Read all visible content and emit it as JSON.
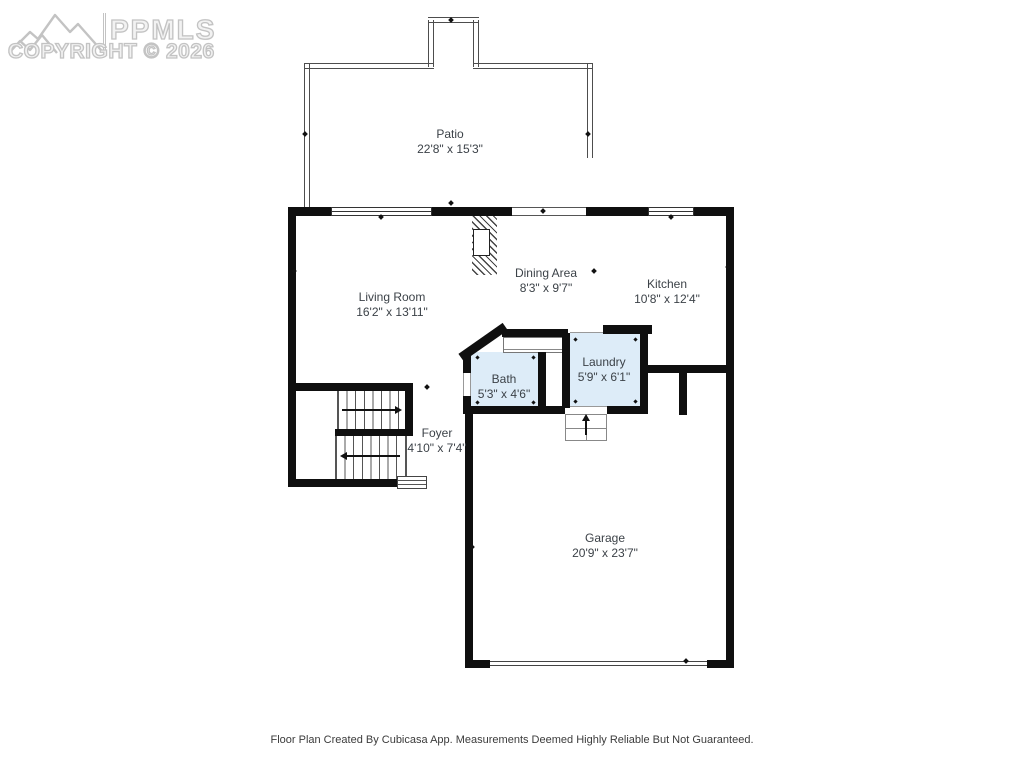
{
  "watermark": {
    "brand": "PPMLS",
    "copyright": "COPYRIGHT © 2026",
    "logo": "mountain-range-icon",
    "color": "#c3c3c3"
  },
  "rooms": {
    "patio": {
      "name": "Patio",
      "dims": "22'8\" x 15'3\""
    },
    "living_room": {
      "name": "Living Room",
      "dims": "16'2\" x 13'11\""
    },
    "dining_area": {
      "name": "Dining Area",
      "dims": "8'3\" x 9'7\""
    },
    "kitchen": {
      "name": "Kitchen",
      "dims": "10'8\" x 12'4\""
    },
    "bath": {
      "name": "Bath",
      "dims": "5'3\" x 4'6\""
    },
    "laundry": {
      "name": "Laundry",
      "dims": "5'9\" x 6'1\""
    },
    "foyer": {
      "name": "Foyer",
      "dims": "4'10\" x 7'4\""
    },
    "garage": {
      "name": "Garage",
      "dims": "20'9\" x 23'7\""
    }
  },
  "footer": {
    "disclaimer": "Floor Plan Created By Cubicasa App. Measurements Deemed Highly Reliable But Not Guaranteed."
  },
  "colors": {
    "wall": "#0f0f0f",
    "room_highlight": "#ddecf8",
    "label_text": "#3c4248"
  }
}
